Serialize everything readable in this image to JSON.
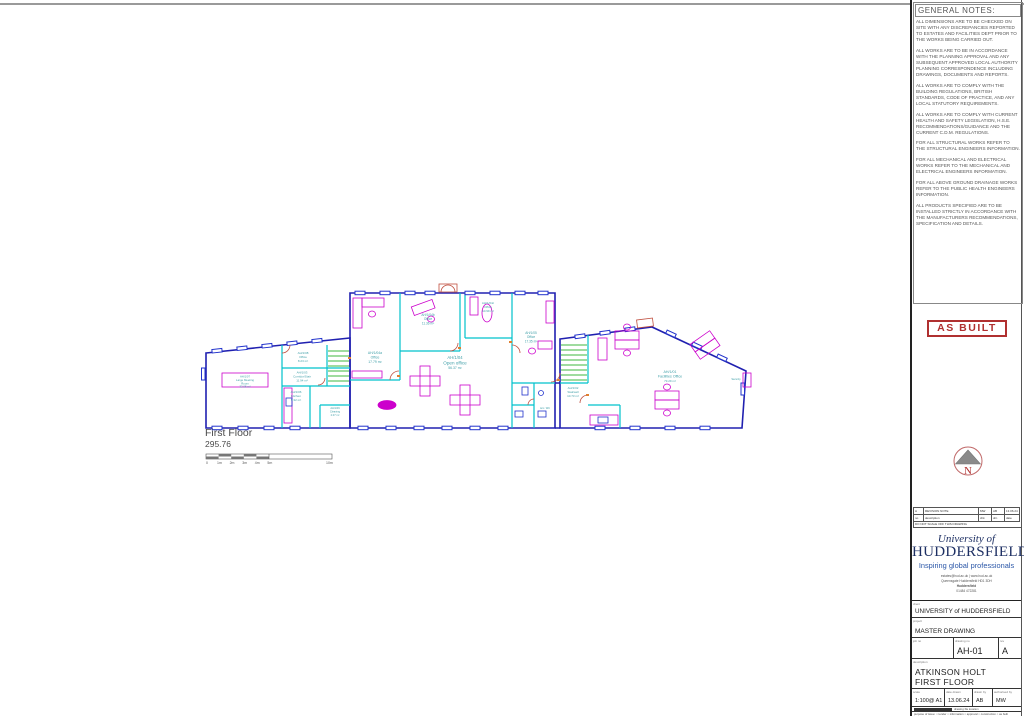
{
  "sheet": {
    "plan_title": "First Floor",
    "plan_elevation": "295.76",
    "scale_ticks": [
      "0",
      "1m",
      "2m",
      "3m",
      "4m",
      "5m",
      "10m"
    ]
  },
  "rooms": [
    {
      "id": "AH/1/07",
      "name": "Large Meeting",
      "name2": "Room",
      "area": "32.08 m²"
    },
    {
      "id": "AH/1/08",
      "name": "Office",
      "area": "8.23 m²"
    },
    {
      "id": "AH/1/03",
      "name": "Corridor/Stair",
      "area": "11.94 m²"
    },
    {
      "id": "AH/1/06",
      "name": "Kitchen",
      "area": "5.32 m²"
    },
    {
      "id": "AH/1/09",
      "name": "Cleaning",
      "area": "2.07 m²"
    },
    {
      "id": "AH/1/04a",
      "name": "Office",
      "area": "17.79 m²"
    },
    {
      "id": "AH/1/04b",
      "name": "Office",
      "area": "11.36 m²"
    },
    {
      "id": "AH/1/04c",
      "name": "Office",
      "area": "10.99 m²"
    },
    {
      "id": "AH/1/04",
      "name": "Open office",
      "area": "56.37 m²"
    },
    {
      "id": "AH/1/05",
      "name": "Office",
      "area": "17.35 m²"
    },
    {
      "id": "AH/1/02",
      "name": "Stairwell",
      "area": "10.73 m²"
    },
    {
      "id": "AH/1/01",
      "name": "Facilities Office",
      "area": "73.29 m²"
    },
    {
      "name": "Acc. WC"
    },
    {
      "name": "Security"
    }
  ],
  "notes": {
    "title": "GENERAL  NOTES:",
    "paragraphs": [
      "ALL DIMENSIONS ARE TO BE CHECKED ON SITE WITH ANY DISCREPANCIES REPORTED TO ESTATES AND FACILITIES DEPT PRIOR TO THE WORKS BEING CARRIED OUT.",
      "ALL WORKS ARE TO BE IN ACCORDANCE WITH THE PLANNING APPROVAL AND ANY SUBSEQUENT APPROVED LOCAL AUTHORITY PLANNING CORRESPONDENCE INCLUDING DRAWINGS, DOCUMENTS AND REPORTS.",
      "ALL WORKS ARE TO COMPLY WITH THE BUILDING REGULATIONS, BRITISH STANDARDS, CODE OF PRACTICE, AND ANY LOCAL STATUTORY REQUIREMENTS.",
      "ALL WORKS ARE TO COMPLY WITH CURRENT HEALTH AND SAFETY LEGISLATION, H.S.E. RECOMMENDATIONS/GUIDANCE AND THE CURRENT C.D.M. REGULATIONS.",
      "FOR ALL STRUCTURAL WORKS REFER TO THE STRUCTURAL ENGINEERS INFORMATION.",
      "FOR ALL MECHANICAL AND ELECTRICAL WORKS REFER TO THE MECHANICAL AND ELECTRICAL ENGINEERS INFORMATION.",
      "FOR ALL ABOVE GROUND DRAINAGE WORKS REFER TO THE PUBLIC HEALTH ENGINEERS INFORMATION.",
      "ALL PRODUCTS SPECIFIED ARE TO BE INSTALLED STRICTLY IN ACCORDANCE WITH THE MANUFACTURERS RECOMMENDATIONS, SPECIFICATION AND DETAILS."
    ]
  },
  "stamp": {
    "text": "AS BUILT",
    "color": "#b03030"
  },
  "north": {
    "letter": "N"
  },
  "revisions": {
    "row": {
      "rev": "A",
      "note": "REVISION NOTE",
      "chk": "MW",
      "drn": "AB",
      "date": "13.06.24"
    },
    "headers": {
      "rev": "no",
      "note": "description",
      "chk": "chk",
      "drn": "drn",
      "date": "date"
    },
    "warning": "DO NOT SCALE OFF THIS DRAWING"
  },
  "logo": {
    "line1": "University of",
    "line2": "HUDDERSFIELD",
    "line3": "Inspiring global professionals",
    "contact1": "estates@hud.ac.uk   |   www.hud.ac.uk",
    "contact2": "Queensgate Huddersfield HD1 3DH",
    "contact3": "Huddersfield",
    "contact4": "01484 472281",
    "brand_color": "#1d2f63"
  },
  "title_block": {
    "client_label": "client",
    "client": "UNIVERSITY of HUDDERSFIELD",
    "project_label": "project",
    "project": "MASTER DRAWING",
    "status_label": "job no",
    "status": "",
    "drawing_no_label": "drawing no",
    "drawing_no": "AH-01",
    "rev_label": "rev",
    "rev": "A",
    "description_label": "description",
    "description_line1": "ATKINSON HOLT",
    "description_line2": "FIRST FLOOR",
    "scale_label": "scale",
    "scale": "1:100@ A1",
    "date_label": "date drawn",
    "date": "13.06.24",
    "drawn_label": "drawn by",
    "drawn": "AB",
    "auth_label": "authorised by",
    "auth": "MW",
    "small_print_1": "drawing file location",
    "small_print_2": "purpose of issue:  ○ tender   ○ information   ○ approval   ○ construction   ○ as built"
  },
  "plan_colors": {
    "wall": "#2020b0",
    "partition": "#00c2cc",
    "window": "#2233cc",
    "furniture": "#cc00cc",
    "stair": "#00a000",
    "door": "#c05040",
    "label": "#3f9fa8"
  }
}
